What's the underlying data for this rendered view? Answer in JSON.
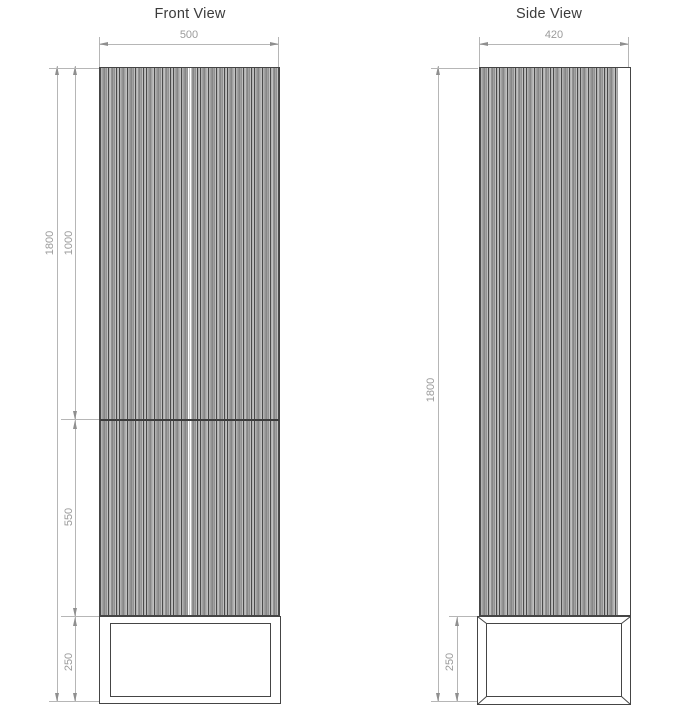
{
  "drawing": {
    "front": {
      "title": "Front View",
      "width_mm": "500",
      "total_height_mm": "1800",
      "upper_section_mm": "1000",
      "lower_section_mm": "550",
      "base_height_mm": "250"
    },
    "side": {
      "title": "Side View",
      "depth_mm": "420",
      "total_height_mm": "1800",
      "base_height_mm": "250"
    },
    "colors": {
      "outline": "#454545",
      "dim_line": "#b6b6b6",
      "dim_text": "#9b9b9b",
      "title_text": "#3b3b3b"
    }
  }
}
